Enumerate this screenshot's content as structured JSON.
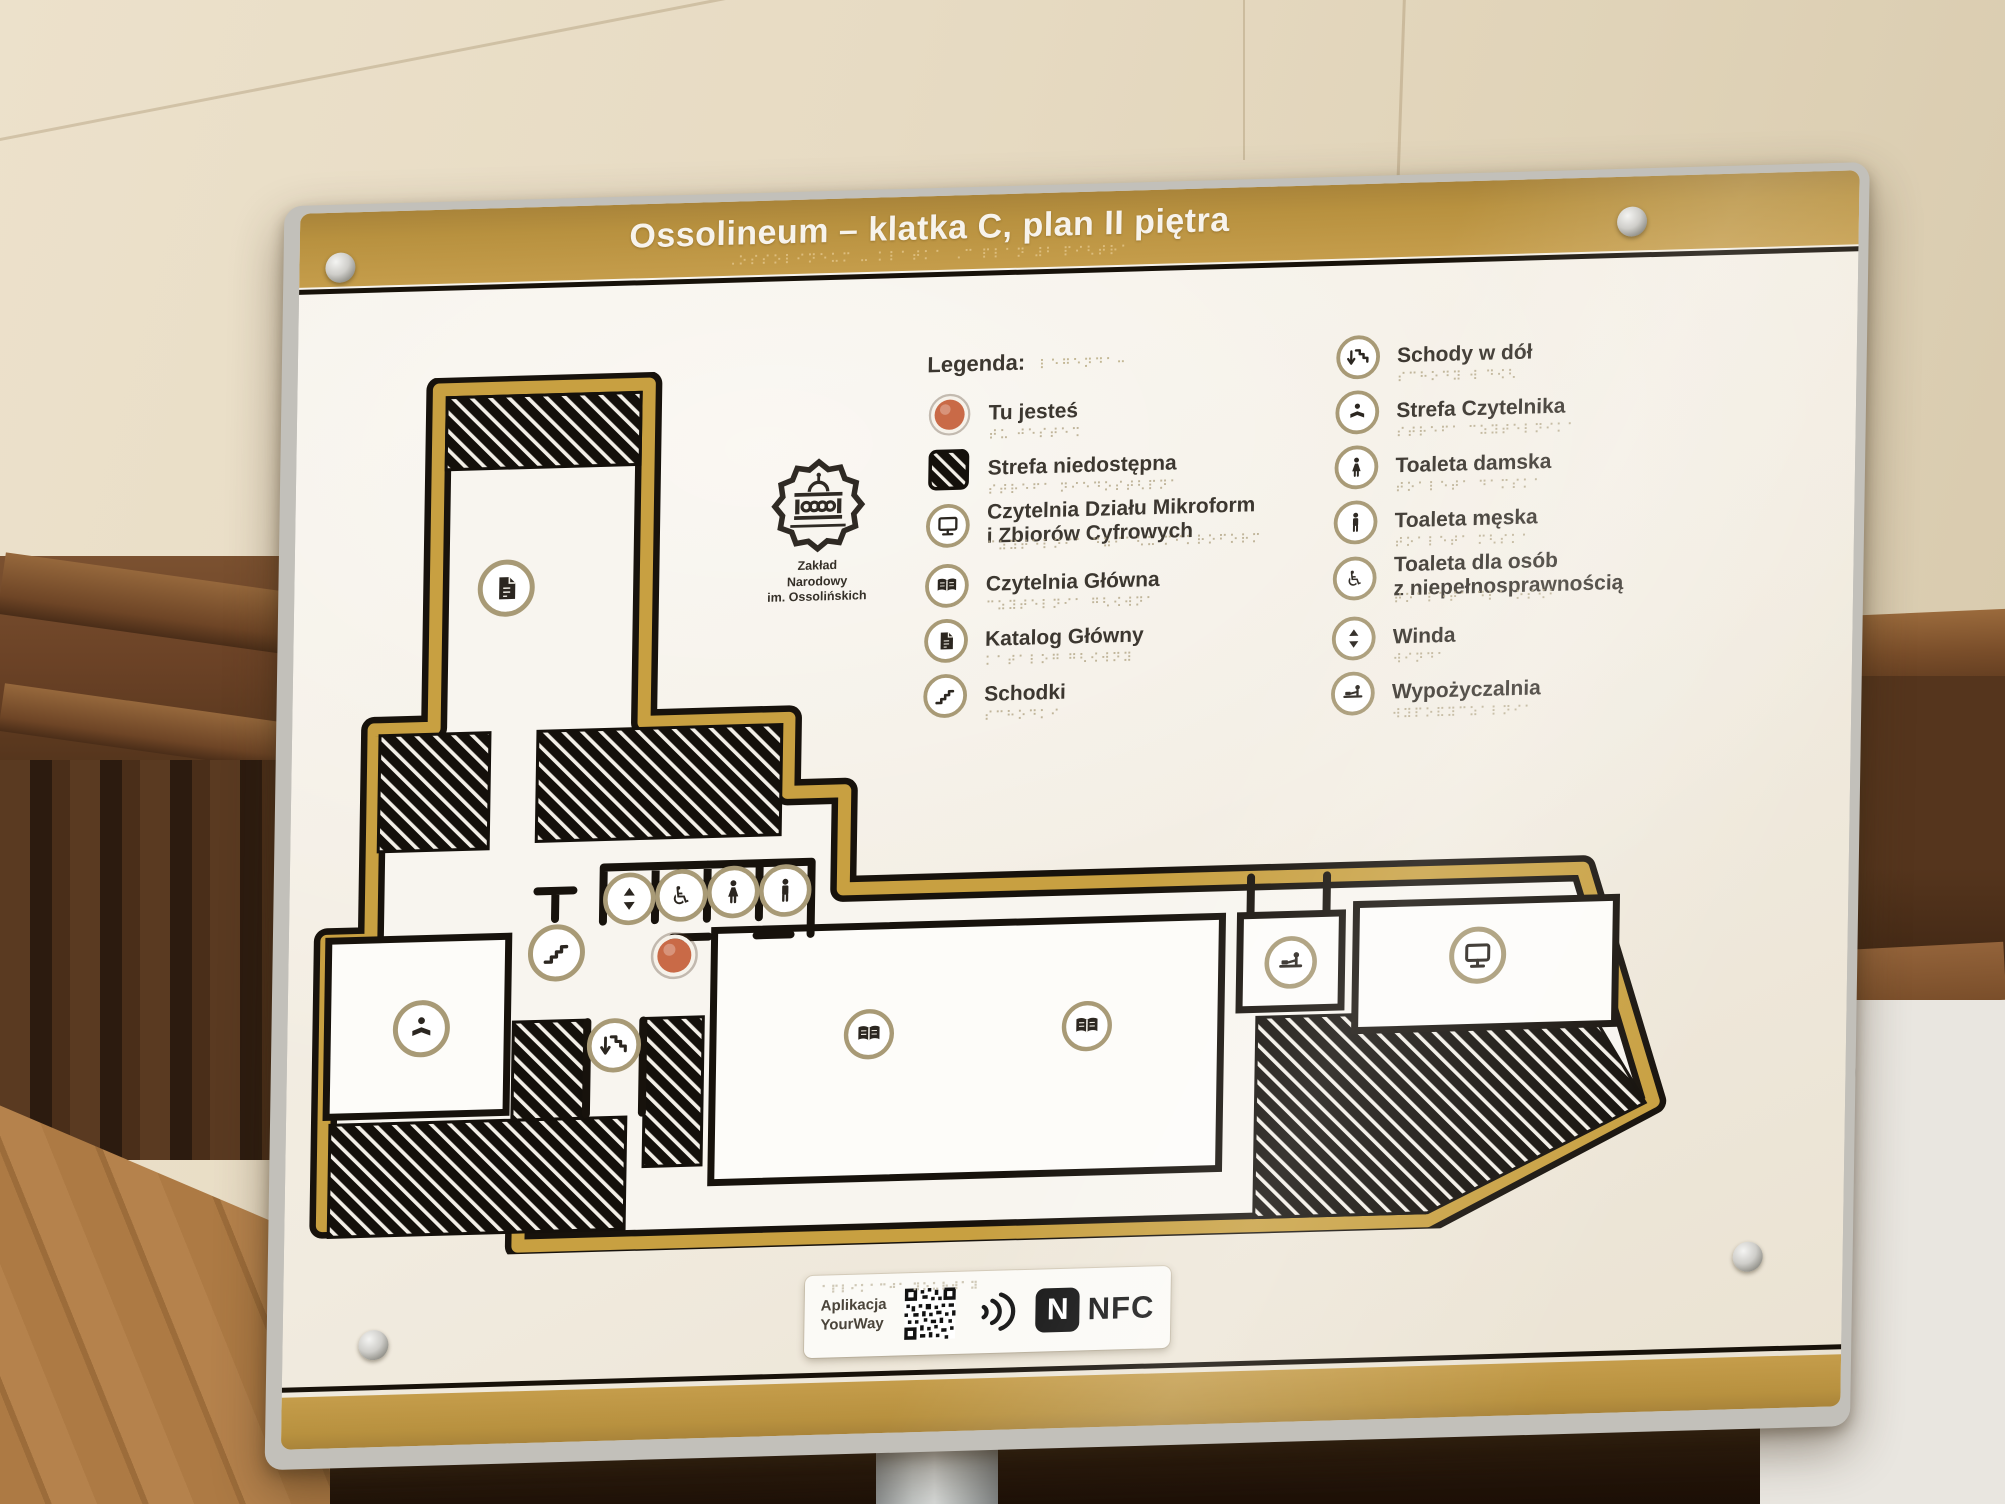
{
  "sign": {
    "title": "Ossolineum – klatka C, plan II piętra",
    "title_braille": "⠠⠕⠎⠎⠕⠇⠊⠝⠑⠥⠍ ⠤ ⠅⠇⠁⠞⠅⠁ ⠠⠉ ⠏⠇⠁⠝ ⠼⠃ ⠏⠊⠣⠞⠗⠁",
    "colors": {
      "band_gold": "#b8913f",
      "plan_outline_gold": "#c8a041",
      "wall_black": "#17120c",
      "here_dot_red": "#c96a47",
      "body_offwhite": "#f1ebdf"
    },
    "logo": {
      "icon": "ossolineum-badge-icon",
      "line1": "Zakład",
      "line2": "Narodowy",
      "line3": "im. Ossolińskich"
    },
    "legend": {
      "heading": "Legenda:",
      "heading_braille": "⠇⠑⠛⠑⠝⠙⠁⠒",
      "column1": [
        {
          "icon": "you-are-here-dot-icon",
          "label": "Tu jesteś",
          "label2": "",
          "braille": "⠞⠥ ⠚⠑⠎⠞⠑⠩"
        },
        {
          "icon": "hatched-area-icon",
          "label": "Strefa niedostępna",
          "label2": "",
          "braille": "⠎⠞⠗⠑⠋⠁ ⠝⠊⠑⠙⠕⠎⠞⠣⠏⠝⠁"
        },
        {
          "icon": "computer-icon",
          "label": "Czytelnia Działu Mikroform",
          "label2": "i Zbiorów Cyfrowych",
          "braille": "⠉⠵⠽⠞⠑⠇⠝⠊⠁ ⠙⠵⠊⠁⠣⠥ ⠍⠊⠅⠗⠕⠋⠕⠗⠍"
        },
        {
          "icon": "open-book-icon",
          "label": "Czytelnia Główna",
          "label2": "",
          "braille": "⠉⠵⠽⠞⠑⠇⠝⠊⠁ ⠛⠣⠪⠺⠝⠁"
        },
        {
          "icon": "document-icon",
          "label": "Katalog Główny",
          "label2": "",
          "braille": "⠅⠁⠞⠁⠇⠕⠛ ⠛⠣⠪⠺⠝⠽"
        },
        {
          "icon": "stairs-icon",
          "label": "Schodki",
          "label2": "",
          "braille": "⠎⠉⠓⠕⠙⠅⠊"
        }
      ],
      "column2": [
        {
          "icon": "stairs-down-icon",
          "label": "Schody w dół",
          "label2": "",
          "braille": "⠎⠉⠓⠕⠙⠽ ⠺ ⠙⠪⠣"
        },
        {
          "icon": "reader-icon",
          "label": "Strefa Czytelnika",
          "label2": "",
          "braille": "⠎⠞⠗⠑⠋⠁ ⠉⠵⠽⠞⠑⠇⠝⠊⠅⠁"
        },
        {
          "icon": "woman-icon",
          "label": "Toaleta damska",
          "label2": "",
          "braille": "⠞⠕⠁⠇⠑⠞⠁ ⠙⠁⠍⠎⠅⠁"
        },
        {
          "icon": "man-icon",
          "label": "Toaleta męska",
          "label2": "",
          "braille": "⠞⠕⠁⠇⠑⠞⠁ ⠍⠣⠎⠅⠁"
        },
        {
          "icon": "wheelchair-icon",
          "label": "Toaleta dla osób",
          "label2": "z niepełnosprawnością",
          "braille": "⠞⠕⠁⠇⠑⠞⠁ ⠙⠇⠁ ⠕⠎⠪⠃"
        },
        {
          "icon": "elevator-arrows-icon",
          "label": "Winda",
          "label2": "",
          "braille": "⠺⠊⠝⠙⠁"
        },
        {
          "icon": "lending-desk-icon",
          "label": "Wypożyczalnia",
          "label2": "",
          "braille": "⠺⠽⠏⠕⠯⠽⠉⠵⠁⠇⠝⠊⠁"
        }
      ]
    },
    "plan": {
      "name": "floor-plan-staircase-C-2nd-floor",
      "placed_icons": [
        "katalog-glowny-document",
        "schodki-stairs",
        "tu-jestes-dot",
        "winda-elevator",
        "toaleta-niepelnosprawni-wheelchair",
        "toaleta-damska-woman",
        "toaleta-meska-man",
        "strefa-czytelnika-reader",
        "schody-w-dol-stairs-down",
        "czytelnia-glowna-book",
        "czytelnia-glowna-book",
        "wypozyczalnia-lending",
        "czytelnia-mikroform-computer"
      ]
    },
    "footer": {
      "app_line1": "Aplikacja",
      "app_line2": "YourWay",
      "app_braille": "⠁⠏⠇⠊⠅⠁⠉⠚⠁ ⠽⠕⠥⠗⠺⠁⠽",
      "qr_icon": "qr-code-icon",
      "waves_icon": "radio-waves-icon",
      "nfc_logo": "nfc-n-mark-icon",
      "nfc_text": "NFC"
    }
  }
}
